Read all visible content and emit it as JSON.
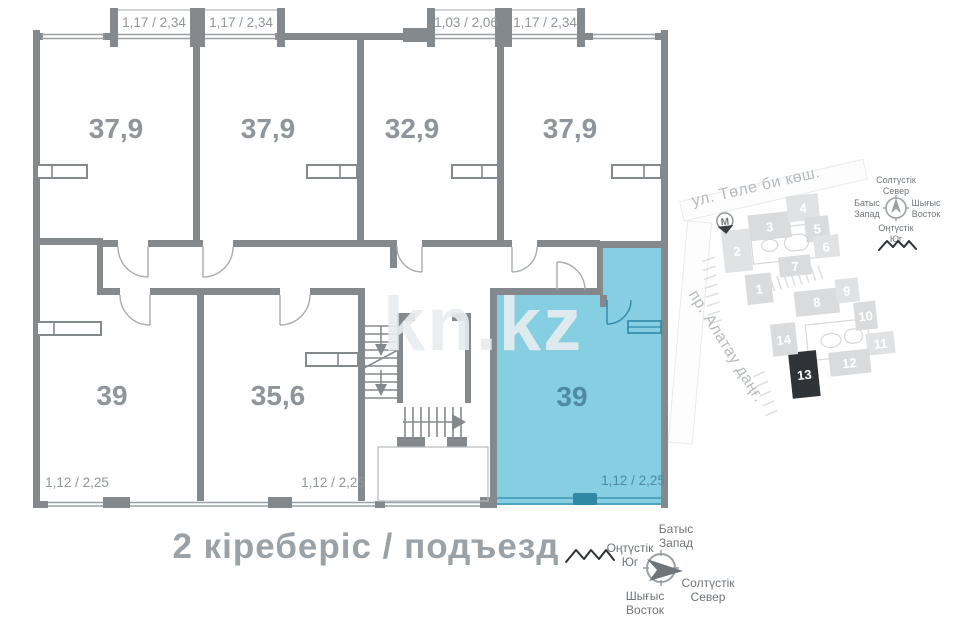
{
  "floor_plan": {
    "caption": "2 кіреберіс / подъезд",
    "watermark": "kn.kz",
    "rooms": [
      {
        "area": "37,9",
        "dim": "1,17 / 2,34"
      },
      {
        "area": "37,9",
        "dim": "1,17 / 2,34"
      },
      {
        "area": "32,9",
        "dim": "1,03 / 2,06"
      },
      {
        "area": "37,9",
        "dim": "1,17 / 2,34"
      },
      {
        "area": "39",
        "dim": "1,12 / 2,25"
      },
      {
        "area": "35,6",
        "dim": "1,12 / 2,25"
      },
      {
        "area": "39",
        "dim": "1,12 / 2,25",
        "highlighted": true
      }
    ]
  },
  "site_map": {
    "street_top": "ул. Төле би көш.",
    "street_left": "пр. Алатау даңғ.",
    "metro_label": "M",
    "highlighted_building": "13",
    "buildings": [
      "1",
      "2",
      "3",
      "4",
      "5",
      "6",
      "7",
      "8",
      "9",
      "10",
      "11",
      "12",
      "13",
      "14"
    ]
  },
  "directions": {
    "north_kk": "Солтүстік",
    "north_ru": "Север",
    "south_kk": "Оңтүстік",
    "south_ru": "Юг",
    "west_kk": "Батыс",
    "west_ru": "Запад",
    "east_kk": "Шығыс",
    "east_ru": "Восток"
  },
  "colors": {
    "wall": "#84898e",
    "highlight_fill": "#86cfe2",
    "highlight_wall": "#2f89a5",
    "highlight_text": "#4e8ba3",
    "label": "#8f959b",
    "map_building": "#d9dbdc",
    "map_building_active": "#2f3338"
  }
}
